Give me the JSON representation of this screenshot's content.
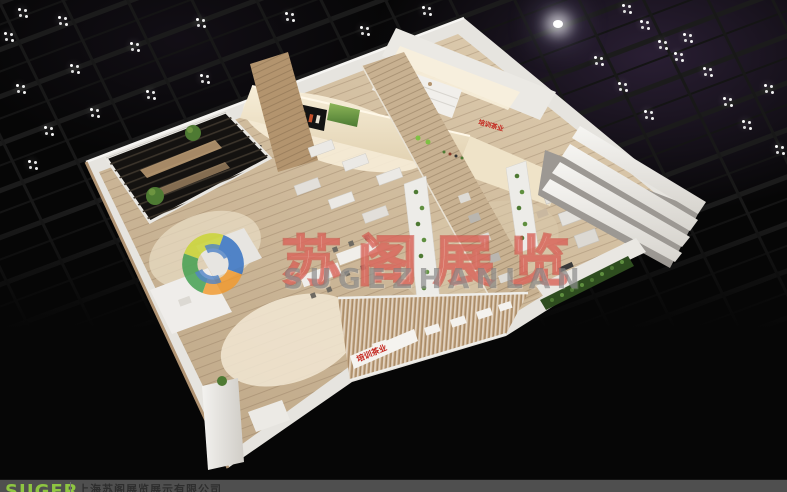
{
  "meta": {
    "width": 787,
    "height": 492,
    "description_label": "exhibition-booth-3d-render"
  },
  "watermark": {
    "brand_cn": "苏阁展览",
    "brand_en": "SUGEZHANLAN",
    "text_color_cn": "#e86a5f",
    "text_color_en": "#7d7d7d",
    "logo_colors": {
      "blue": "#2f6ec2",
      "yellow": "#c9d531",
      "orange": "#f29a2e",
      "green": "#3f9e4d"
    }
  },
  "footer": {
    "logo_text": "SUGER",
    "company_name": "上海苏阁展览展示有限公司",
    "bar_color": "#4f4f4f",
    "logo_color": "#8ec641",
    "company_text_color": "#2e2e2e"
  },
  "booth": {
    "signs": {
      "facade_sign": "培训茶业",
      "back_wall_sign": "培训茶业",
      "inner_wall_sign": "培训茶业",
      "sign_color": "#c3241c"
    },
    "colors": {
      "floor_wood": "#cdb899",
      "wall_white": "#e8e6e1",
      "wood_wall": "#b3946e",
      "hedge_green": "#2e4d1f",
      "plant_green": "#4e7a33",
      "counter_cream": "#f2e7cd",
      "pergola_dark": "#141210"
    }
  },
  "ceiling": {
    "truss_color": "#1b1b1b",
    "glow_purple": "#463258",
    "bright_lamp": [
      553,
      20
    ],
    "light_clusters": [
      [
        18,
        8
      ],
      [
        58,
        16
      ],
      [
        130,
        42
      ],
      [
        196,
        18
      ],
      [
        70,
        64
      ],
      [
        16,
        84
      ],
      [
        4,
        32
      ],
      [
        146,
        90
      ],
      [
        200,
        74
      ],
      [
        90,
        108
      ],
      [
        44,
        126
      ],
      [
        28,
        160
      ],
      [
        285,
        12
      ],
      [
        360,
        26
      ],
      [
        422,
        6
      ],
      [
        622,
        4
      ],
      [
        640,
        20
      ],
      [
        658,
        40
      ],
      [
        674,
        52
      ],
      [
        594,
        56
      ],
      [
        618,
        82
      ],
      [
        644,
        110
      ],
      [
        683,
        33
      ],
      [
        703,
        67
      ],
      [
        723,
        97
      ],
      [
        742,
        120
      ],
      [
        764,
        84
      ],
      [
        775,
        145
      ]
    ]
  }
}
